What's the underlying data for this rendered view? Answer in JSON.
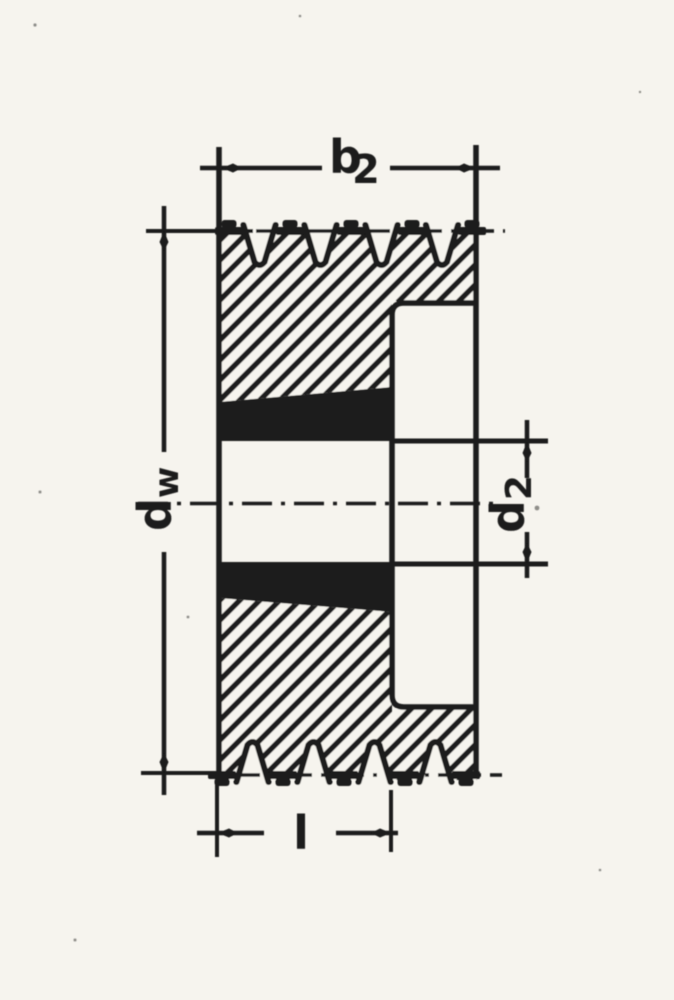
{
  "drawing": {
    "type": "technical-section-drawing",
    "subject": "V-belt pulley cross-section with taper bushing, five grooves, dimension callouts",
    "colors": {
      "paper": "#f6f4ee",
      "ink": "#1a1a1a"
    },
    "labels": {
      "groove_width": {
        "base": "b",
        "sub": "2"
      },
      "pitch_diameter": {
        "base": "d",
        "sub": "w"
      },
      "hub_diameter": {
        "base": "d",
        "sub": "2"
      },
      "hub_length": {
        "base": "l",
        "sub": ""
      }
    }
  }
}
